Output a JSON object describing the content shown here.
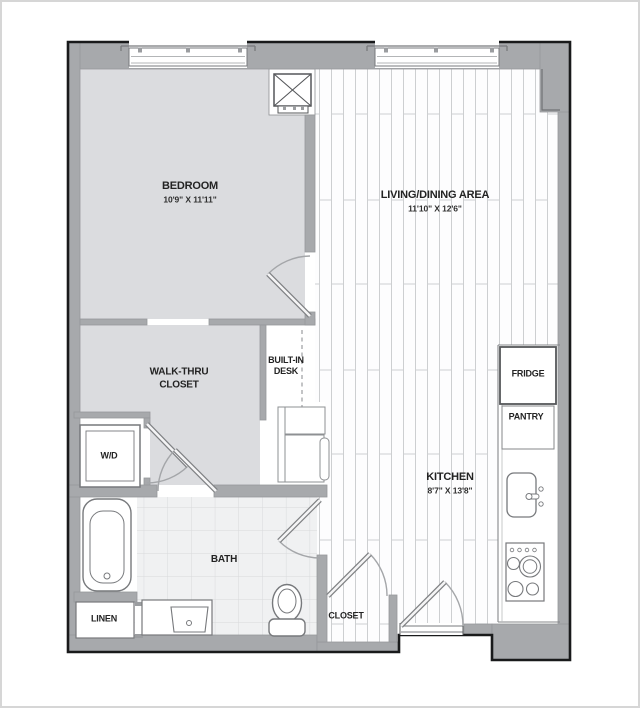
{
  "plan_type": "apartment-floor-plan",
  "palette": {
    "wall_fill": "#a7a9ac",
    "outline": "#191a1b",
    "bedroom_floor": "#dbdcdf",
    "tile_floor": "#f0f1f2",
    "plank_floor": "#fdfdfe",
    "plank_line": "#cdcfd1",
    "tile_line": "#d8d9db",
    "fixture_stroke": "#77797c",
    "label_text": "#232323"
  },
  "rooms": {
    "bedroom": {
      "name": "BEDROOM",
      "dims": "10'9\" X 11'11\""
    },
    "living": {
      "name": "LIVING/DINING AREA",
      "dims": "11'10\" X 12'6\""
    },
    "kitchen": {
      "name": "KITCHEN",
      "dims": "8'7\" X 13'8\""
    },
    "walk_thru": {
      "line1": "WALK-THRU",
      "line2": "CLOSET"
    },
    "desk": {
      "line1": "BUILT-IN",
      "line2": "DESK"
    },
    "wd": {
      "name": "W/D"
    },
    "bath": {
      "name": "BATH"
    },
    "linen": {
      "name": "LINEN"
    },
    "closet": {
      "name": "CLOSET"
    },
    "fridge": {
      "name": "FRIDGE"
    },
    "pantry": {
      "name": "PANTRY"
    }
  }
}
